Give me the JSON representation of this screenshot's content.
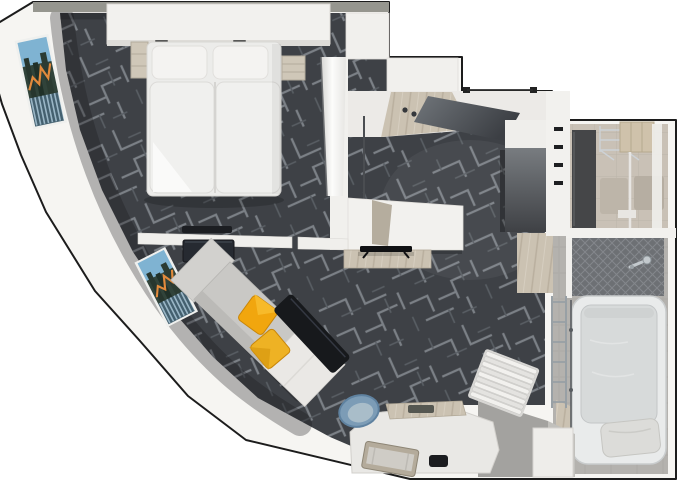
{
  "image": {
    "type": "3d-floor-plan",
    "subject": "top-down render of a studio suite with bedroom, living area, entry hall, walk-in closet, shower and bathtub",
    "width_px": 680,
    "height_px": 486
  },
  "colors": {
    "background": "#ffffff",
    "outline": "#1c1c1c",
    "wall": "#f6f5f2",
    "wall_top_strip": "#96968f",
    "carpet": "#3e4146",
    "carpet_lines": "#7b8086",
    "carpet_lines_dark": "#595e64",
    "wood_floor": "#cbc2b2",
    "closet_floor": "#c9c1b6",
    "stone_floor": "#b4b2ae",
    "shower_tile": "#6d7074",
    "bathtub": "#e9ebeb",
    "tub_basin": "#d7dada",
    "bed_linen": "#ececea",
    "sofa": "#c9c8c5",
    "sofa_chaise": "#eae8e5",
    "pillow_yellow_1": "#f1a60e",
    "pillow_yellow_2": "#eeb224",
    "bench_black": "#17191c",
    "tv_dark": "#262a31",
    "chair_blue": "#7c9cb6",
    "desk": "#e9e8e5",
    "wardrobe_dark": "#454648",
    "window_sky": "#7fb3d2",
    "window_dark": "#31433a",
    "window_accent_orange": "#e28a3c",
    "chrome": "#c3c9cd"
  },
  "rooms": [
    {
      "name": "bedroom"
    },
    {
      "name": "living-area"
    },
    {
      "name": "entry-hall"
    },
    {
      "name": "walk-in-closet"
    },
    {
      "name": "shower-room"
    },
    {
      "name": "bath-area"
    },
    {
      "name": "work-nook"
    }
  ],
  "furniture": [
    "double-bed",
    "headboard-shelf",
    "nightstand-left",
    "nightstand-right",
    "luggage-rack",
    "media-wall-tv",
    "tv-sideboard",
    "television",
    "sofa",
    "yellow-cushion-1",
    "yellow-cushion-2",
    "black-coffee-bench",
    "work-desk",
    "blue-tub-chair",
    "luggage-bench",
    "phone",
    "wardrobe",
    "wire-shelving",
    "shower",
    "bathtub",
    "bath-pillow",
    "towel-ladder",
    "vanity-cabinet",
    "louvered-panel",
    "window-picture-upper",
    "window-picture-lower"
  ]
}
